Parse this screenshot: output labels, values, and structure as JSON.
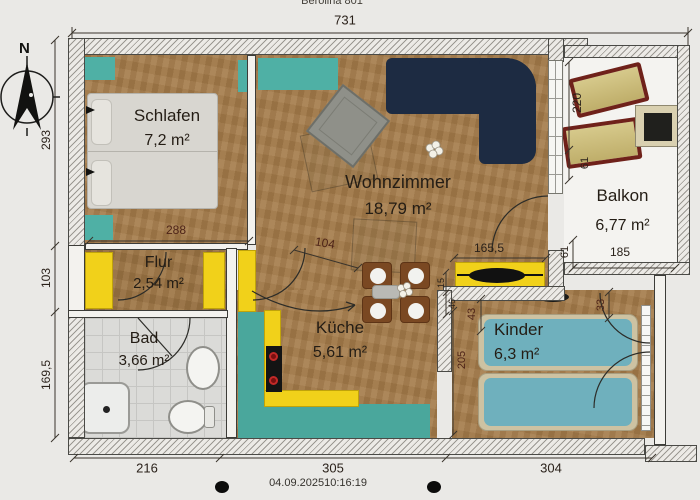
{
  "header": {
    "doc_title": "Berolina 801"
  },
  "footer": {
    "timestamp": "04.09.202510:16:19"
  },
  "compass": {
    "north_label": "N"
  },
  "rooms": {
    "schlafen": {
      "name": "Schlafen",
      "area": "7,2 m²"
    },
    "wohnzimmer": {
      "name": "Wohnzimmer",
      "area": "18,79 m²"
    },
    "balkon": {
      "name": "Balkon",
      "area": "6,77 m²"
    },
    "flur": {
      "name": "Flur",
      "area": "2,54 m²"
    },
    "bad": {
      "name": "Bad",
      "area": "3,66 m²"
    },
    "kueche": {
      "name": "Küche",
      "area": "5,61 m²"
    },
    "kinder": {
      "name": "Kinder",
      "area": "6,3 m²"
    }
  },
  "dimensions": {
    "total_width": "731",
    "left_top": "293",
    "left_mid": "103",
    "left_bottom": "169,5",
    "schlafen_width": "288",
    "hall_diagonal": "104",
    "sideboard": "165,5",
    "balkon_height": "220",
    "balkon_inner": "61",
    "balkon_gap": "61",
    "balkon_width": "185",
    "kinder_top_left": "43",
    "kinder_top_right": "33",
    "kinder_height": "205",
    "wall_small_a": "15",
    "wall_small_b": "46",
    "bottom_left": "216",
    "bottom_center": "305",
    "bottom_right": "304"
  },
  "colors": {
    "wood": "#a57c4a",
    "teal": "#4fb0a5",
    "counter_yellow": "#f1d11a",
    "sofa_navy": "#1d2b42",
    "bed_gray": "#d8d6d0",
    "kids_bed_blue": "#6fb0bd",
    "lounger_tan": "#cbbd7c",
    "lounger_frame": "#6f211a",
    "stove_black": "#141414",
    "burner_red": "#c22a28",
    "wall_fill": "#eceae6",
    "tile_gray": "#dbdbd8"
  }
}
